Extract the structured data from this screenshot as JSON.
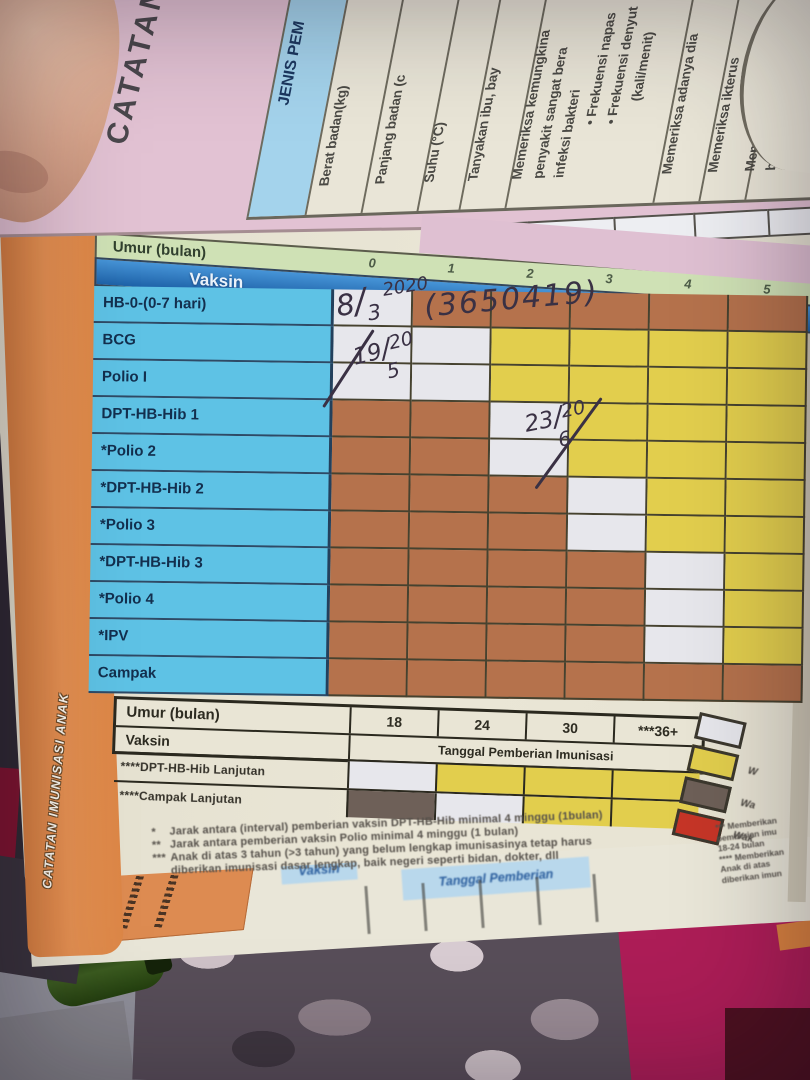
{
  "band_title": "CATATAN IMUNISASI ANAK",
  "prev_page": {
    "side_title": "CATATAN",
    "table_header": "JENIS PEM",
    "exam_items": [
      {
        "lines": [
          "Berat badan(kg)"
        ]
      },
      {
        "lines": [
          "Panjang badan (c"
        ]
      },
      {
        "lines": [
          "Suhu (°C)"
        ]
      },
      {
        "lines": [
          "Tanyakan  ibu,  bay"
        ]
      },
      {
        "lines": [
          "Memeriksa kemungkina",
          "penyakit sangat bera",
          "infeksi  bakteri",
          "• Frekuensi  napas",
          "• Frekuensi  denyut",
          "(kali/menit)"
        ]
      },
      {
        "lines": [
          "Memeriksa adanya dia"
        ]
      },
      {
        "lines": [
          "Memeriksa ikterus"
        ]
      },
      {
        "lines": [
          "Memeriksa kemungkina",
          "badan rendah dan/ata",
          "pemberian ASI"
        ]
      },
      {
        "lines": [
          "Memeriksa status pem"
        ]
      }
    ]
  },
  "main_table": {
    "age_label": "Umur (bulan)",
    "vaccine_label": "Vaksin",
    "date_label_fragment": "Tangga",
    "ages": [
      "0",
      "1",
      "2",
      "3",
      "4",
      "5"
    ],
    "rows": [
      {
        "vaccine": "HB-0-(0-7 hari)",
        "cells": [
          "W",
          "B",
          "B",
          "B",
          "B",
          "B"
        ]
      },
      {
        "vaccine": "BCG",
        "cells": [
          "W",
          "W",
          "Y",
          "Y",
          "Y",
          "Y"
        ]
      },
      {
        "vaccine": "Polio I",
        "cells": [
          "W",
          "W",
          "Y",
          "Y",
          "Y",
          "Y"
        ]
      },
      {
        "vaccine": "DPT-HB-Hib 1",
        "cells": [
          "B",
          "B",
          "W",
          "Y",
          "Y",
          "Y"
        ]
      },
      {
        "vaccine": "*Polio 2",
        "cells": [
          "B",
          "B",
          "W",
          "Y",
          "Y",
          "Y"
        ]
      },
      {
        "vaccine": "*DPT-HB-Hib 2",
        "cells": [
          "B",
          "B",
          "B",
          "W",
          "Y",
          "Y"
        ]
      },
      {
        "vaccine": "*Polio 3",
        "cells": [
          "B",
          "B",
          "B",
          "W",
          "Y",
          "Y"
        ]
      },
      {
        "vaccine": "*DPT-HB-Hib 3",
        "cells": [
          "B",
          "B",
          "B",
          "B",
          "W",
          "Y"
        ]
      },
      {
        "vaccine": "*Polio 4",
        "cells": [
          "B",
          "B",
          "B",
          "B",
          "W",
          "Y"
        ]
      },
      {
        "vaccine": "*IPV",
        "cells": [
          "B",
          "B",
          "B",
          "B",
          "W",
          "Y"
        ]
      },
      {
        "vaccine": "Campak",
        "cells": [
          "B",
          "B",
          "B",
          "B",
          "B",
          "B"
        ]
      }
    ]
  },
  "cell_colors": {
    "W": "#e7e7ec",
    "Y": "#e2ce4d",
    "B": "#b5724c",
    "D": "#6e6058"
  },
  "handwriting": {
    "hb0_date": {
      "day": "8",
      "month": "3",
      "year": "2020"
    },
    "batch_number": "(3650419)",
    "bcg_polio1_date": {
      "day": "19",
      "month": "5",
      "year": "20"
    },
    "dpt1_polio2_date": {
      "day": "23",
      "month": "6",
      "year": "20"
    }
  },
  "booster_table": {
    "age_label": "Umur (bulan)",
    "vaccine_label": "Vaksin",
    "date_label": "Tanggal Pemberian Imunisasi",
    "ages": [
      "18",
      "24",
      "30",
      "***36+"
    ],
    "rows": [
      {
        "vaccine": "****DPT-HB-Hib Lanjutan",
        "cells": [
          "W",
          "Y",
          "Y",
          "Y"
        ]
      },
      {
        "vaccine": "****Campak Lanjutan",
        "cells": [
          "D",
          "W",
          "Y",
          "Y"
        ]
      }
    ]
  },
  "legend": {
    "items": [
      {
        "color": "#e7e7ec",
        "label": ""
      },
      {
        "color": "#e2ce4d",
        "label": "W"
      },
      {
        "color": "#6e6058",
        "label": "Wa"
      },
      {
        "color": "#c63527",
        "label": "Wak"
      }
    ]
  },
  "footnotes": [
    {
      "marker": "*",
      "text": "Jarak antara (interval) pemberian vaksin DPT-HB-Hib minimal 4 minggu (1bulan)"
    },
    {
      "marker": "**",
      "text": "Jarak antara pemberian vaksin Polio minimal 4 minggu (1 bulan)"
    },
    {
      "marker": "***",
      "text": "Anak di atas 3 tahun (>3 tahun) yang belum lengkap imunisasinya tetap harus"
    },
    {
      "marker": "",
      "text": "diberikan imunisasi dasar lengkap, baik negeri seperti bidan, dokter, dll"
    }
  ],
  "footnotes_right": [
    "*** Memberikan",
    "pemberian imu",
    "18-24 bulan",
    "**** Memberikan",
    "Anak di atas",
    "diberikan imun"
  ],
  "next_page": {
    "vaccine_label": "Vaksin",
    "date_label": "Tanggal Pemberian"
  }
}
